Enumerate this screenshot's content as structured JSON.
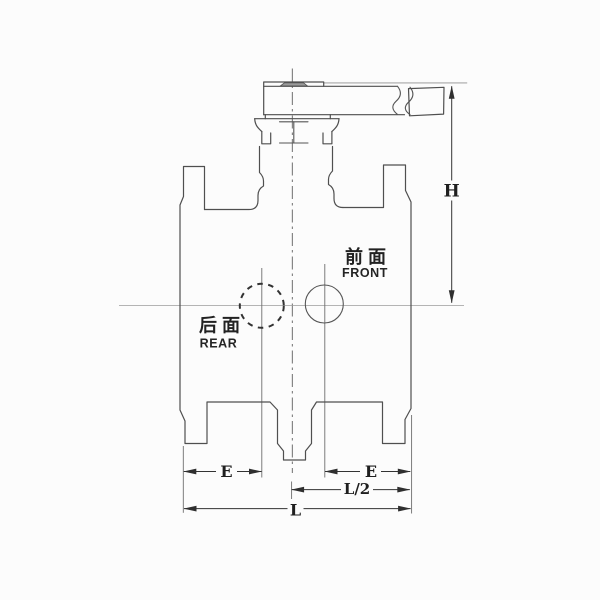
{
  "drawing": {
    "type": "technical-diagram",
    "subject": "valve front elevation with lever handle",
    "labels": {
      "front_cn": "前面",
      "front_en": "FRONT",
      "rear_cn": "后面",
      "rear_en": "REAR"
    },
    "dimensions": {
      "height": "H",
      "left_offset": "E",
      "right_offset": "E",
      "half_length": "L/2",
      "length": "L"
    },
    "colors": {
      "background": "#fcfcfc",
      "outline": "#4f4f4f",
      "dimension_line": "#333333",
      "centerline": "#5f5f5f",
      "text": "#222222"
    }
  }
}
